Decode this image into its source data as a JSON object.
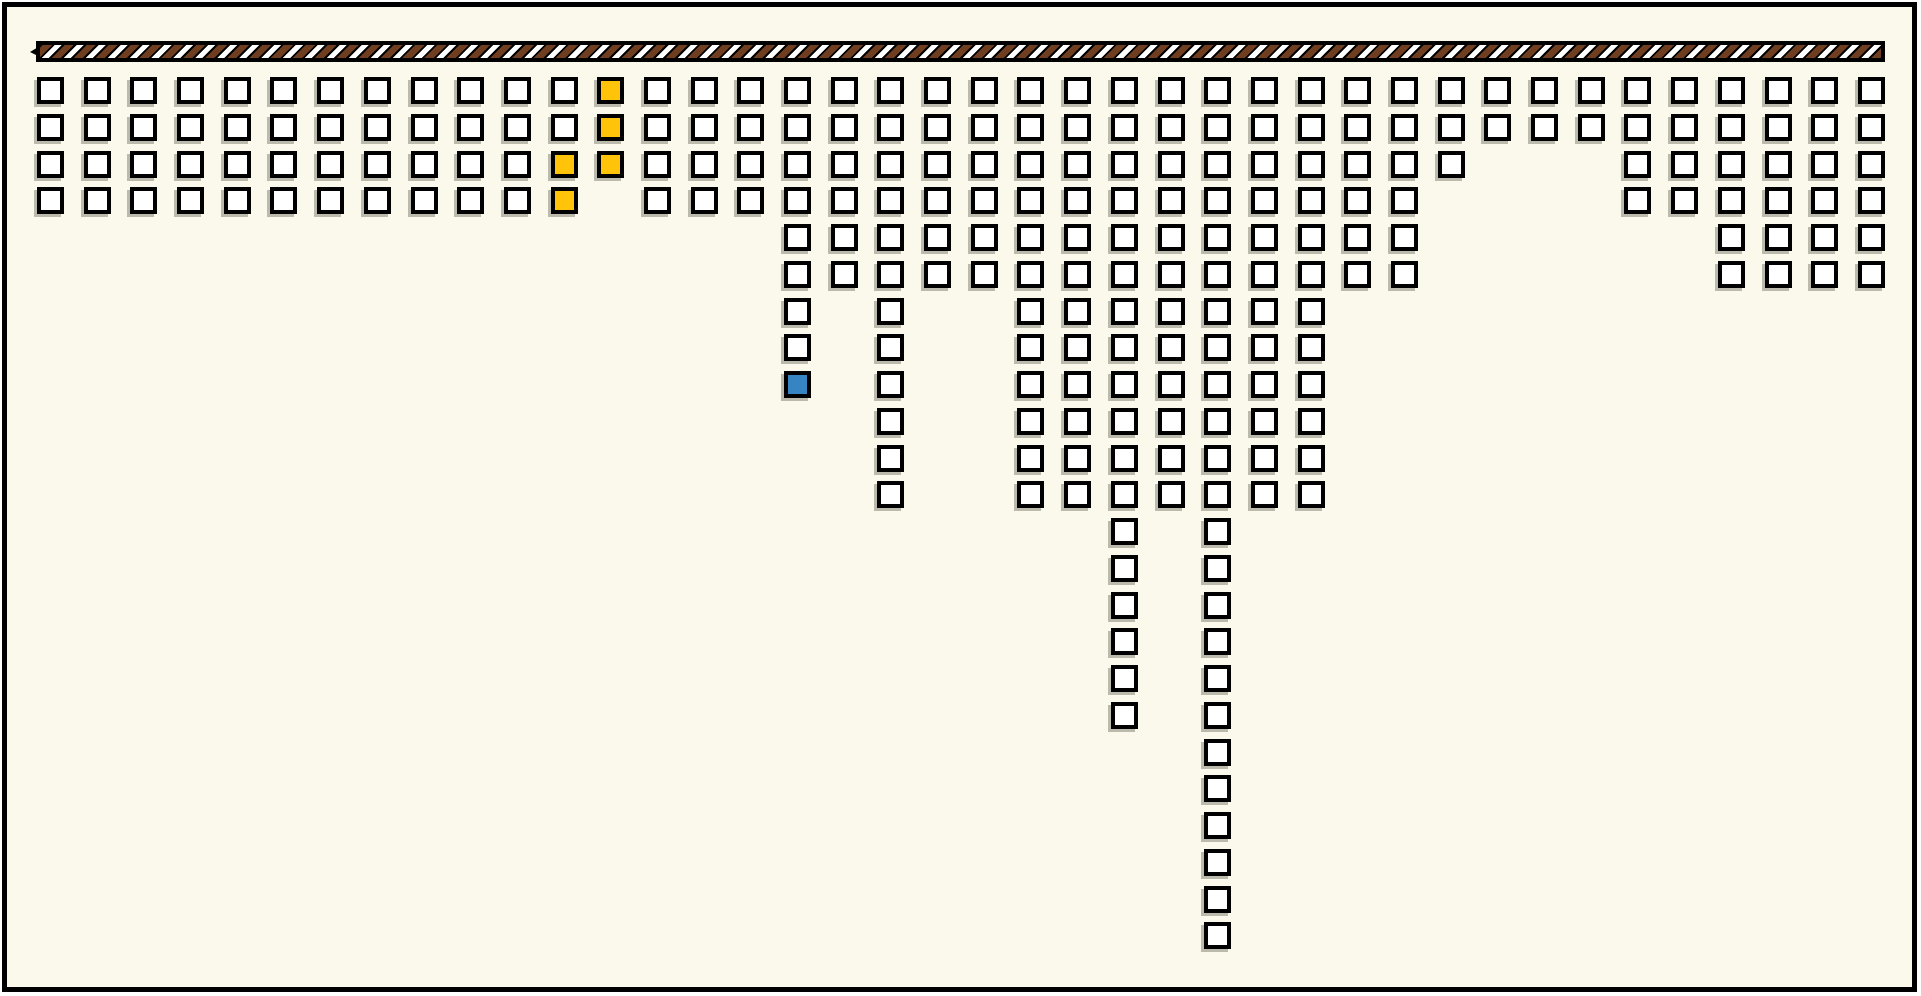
{
  "canvas": {
    "outer_background": "#FFFFFF",
    "frame_border_color": "#000000",
    "interior_background": "#FBF9EC"
  },
  "rope_bar": {
    "description": "horizontal diagonally-striped rope/pole spanning the top, squares hang below it",
    "stripe_brown": "#6F3D20",
    "stripe_white": "#FFFFFF",
    "stripe_gap_black": "#000000"
  },
  "colors": {
    "unit_fill": "#FFFFFF",
    "unit_border": "#000000",
    "yellow": "#FFC40A",
    "blue": "#3684C1",
    "background": "#FBF9EC",
    "rope_brown": "#6F3D20",
    "rope_white": "#FFFFFF",
    "rope_black": "#000000"
  },
  "chart_data": {
    "type": "bar",
    "subtype": "hanging-unit-square-pictogram",
    "title": "",
    "xlabel": "",
    "ylabel": "",
    "orientation": "columns of unit squares hang downward from a striped rope bar",
    "legend": "none",
    "grid": false,
    "categories": [
      1,
      2,
      3,
      4,
      5,
      6,
      7,
      8,
      9,
      10,
      11,
      12,
      13,
      14,
      15,
      16,
      17,
      18,
      19,
      20,
      21,
      22,
      23,
      24,
      25,
      26,
      27,
      28,
      29,
      30,
      31,
      32,
      33,
      34,
      35,
      36,
      37,
      38,
      39,
      40
    ],
    "values": [
      4,
      4,
      4,
      4,
      4,
      4,
      4,
      4,
      4,
      4,
      4,
      4,
      3,
      4,
      4,
      4,
      9,
      6,
      12,
      6,
      6,
      12,
      12,
      18,
      12,
      24,
      12,
      12,
      6,
      6,
      3,
      2,
      2,
      2,
      4,
      4,
      6,
      6,
      6,
      6
    ],
    "total_units": 257,
    "max_column_length": 24,
    "highlighted_units": [
      {
        "column": 12,
        "rows": [
          3,
          4
        ],
        "color_key": "yellow"
      },
      {
        "column": 13,
        "rows": [
          1,
          2,
          3
        ],
        "color_key": "yellow"
      },
      {
        "column": 17,
        "rows": [
          9
        ],
        "color_key": "blue"
      }
    ],
    "highlight_summary": {
      "yellow_count": 5,
      "blue_count": 1,
      "white_count": 251
    }
  }
}
